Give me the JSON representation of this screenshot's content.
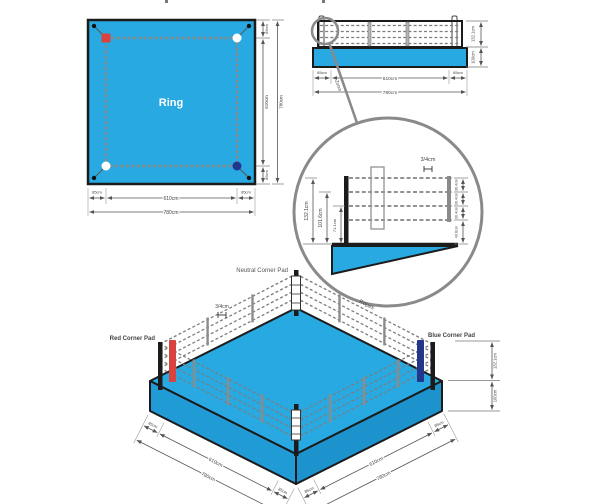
{
  "colors": {
    "ring_blue": "#29A9E1",
    "ring_blue_dark": "#219BD6",
    "ring_blue_dark2": "#1D93CD",
    "red_pad": "#D8433F",
    "navy_pad": "#24368C",
    "red_text": "#E03131",
    "blue_text": "#2243C8"
  },
  "top_view": {
    "ring_label": "Ring",
    "dims": {
      "apron_top": "85cm",
      "height": "610cm",
      "apron_bottom": "85cm",
      "total_height": "780cm",
      "apron_left": "85cm",
      "width": "610cm",
      "apron_right": "85cm",
      "total_width": "780cm"
    }
  },
  "side_view": {
    "zoom_label": "Zoom",
    "dims": {
      "ropes_height": "132.1cm",
      "platform_height": "100cm",
      "apron_left": "85cm",
      "width": "610cm",
      "apron_right": "85cm",
      "total_width": "780cm"
    }
  },
  "detail_view": {
    "rope_thickness": "3/4cm",
    "top_rope_height": "132.1cm",
    "third_rope_height": "101.6cm",
    "second_rope_height": "71.1cm",
    "gap_top": "30.4cm",
    "gap_mid": "30.4cm",
    "gap_low": "30.4cm",
    "gap_bottom": "40.6cm"
  },
  "iso_view": {
    "labels": {
      "neutral": "Neutral Corner Pad",
      "red": "Red Corner Pad",
      "blue": "Blue Corner Pad",
      "ropes": "Ropes"
    },
    "rope_thickness": "3/4cm",
    "dims": {
      "ropes_height": "132.1cm",
      "platform_height": "100cm"
    },
    "left_dims": {
      "apron_back": "85cm",
      "width": "610cm",
      "apron_front": "85cm",
      "total": "780cm"
    },
    "right_dims": {
      "apron_front": "85cm",
      "width": "610cm",
      "apron_back": "85cm",
      "total": "780cm"
    }
  }
}
